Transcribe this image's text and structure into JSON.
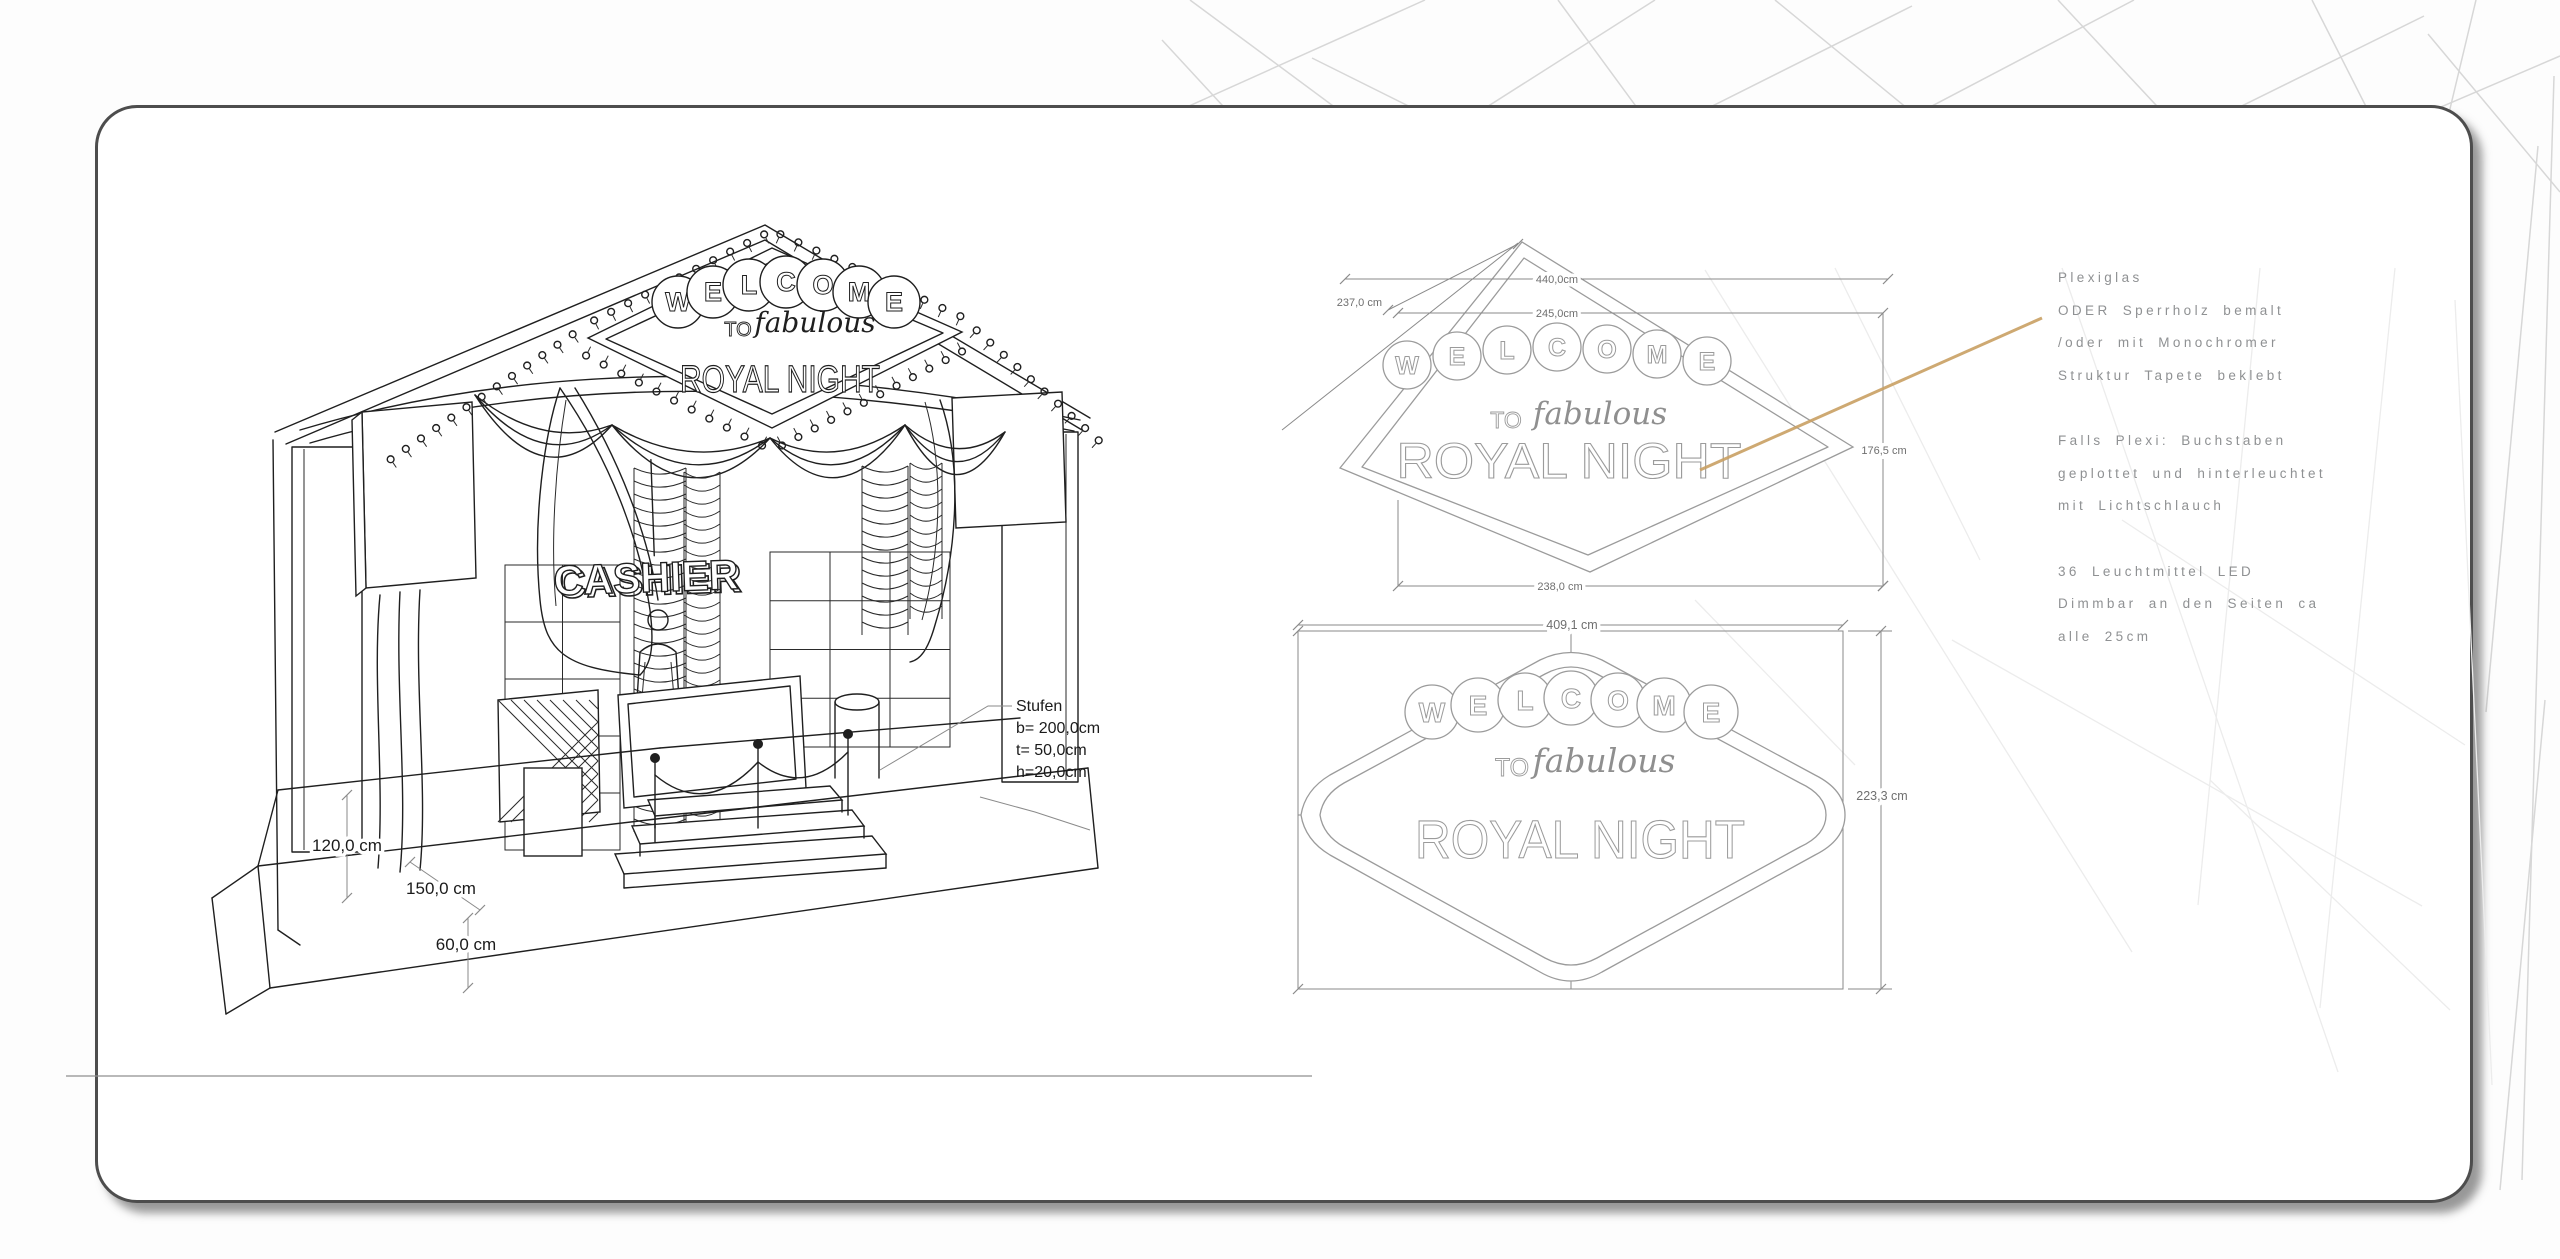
{
  "stage": {
    "marquee": {
      "letters": [
        "W",
        "E",
        "L",
        "C",
        "O",
        "M",
        "E"
      ],
      "to": "TO",
      "fabulous": "fabulous",
      "title": "ROYAL NIGHT"
    },
    "cashier_sign": "CASHIER",
    "steps_note": {
      "title": "Stufen",
      "width": "b= 200,0cm",
      "depth": "t= 50,0cm",
      "height": "h=20,0cm"
    },
    "dimensions": {
      "stage_height": "120,0 cm",
      "stage_depth": "150,0 cm",
      "base_height": "60,0 cm"
    }
  },
  "sign_top_view": {
    "letters": [
      "W",
      "E",
      "L",
      "C",
      "O",
      "M",
      "E"
    ],
    "to": "TO",
    "fabulous": "fabulous",
    "title": "ROYAL NIGHT",
    "dimensions": {
      "edge": "237,0 cm",
      "outer_width": "440,0cm",
      "inner_width": "245,0cm",
      "side_height": "176,5 cm",
      "bottom_width": "238,0 cm"
    }
  },
  "sign_front_view": {
    "letters": [
      "W",
      "E",
      "L",
      "C",
      "O",
      "M",
      "E"
    ],
    "to": "TO",
    "fabulous": "fabulous",
    "title": "ROYAL NIGHT",
    "dimensions": {
      "width": "409,1 cm",
      "height": "223,3 cm"
    }
  },
  "notes": {
    "material": [
      "Plexiglas",
      "ODER Sperrholz bemalt",
      "/oder mit Monochromer",
      "Struktur Tapete beklebt"
    ],
    "plexi": [
      "Falls Plexi: Buchstaben",
      "geplottet und hinterleuchtet",
      "mit Lichtschlauch"
    ],
    "lighting": [
      "36 Leuchtmittel LED",
      "Dimmbar an den Seiten ca",
      "alle 25cm"
    ]
  },
  "colors": {
    "callout": "#c9a063",
    "ink": "#1f1f1f",
    "diagram_gray": "#9b9b9b",
    "note_text": "#8f9193",
    "wireframe": "#d7d7d7"
  }
}
